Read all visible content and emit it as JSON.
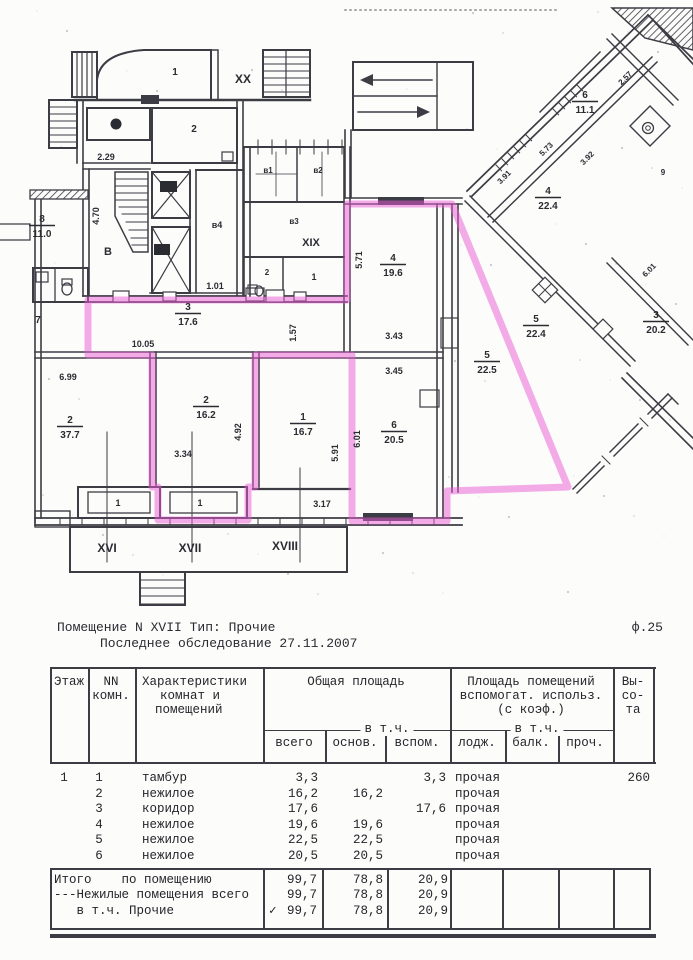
{
  "doc": {
    "title_line1": "Помещение N XVII Тип: Прочие",
    "form_ref": "ф.25",
    "title_line2": "Последнее обследование 27.11.2007"
  },
  "plan": {
    "highlight_color": "#ea5ad5",
    "fraction_labels": [
      {
        "n": "8",
        "a": "11.0",
        "x": 42,
        "y": 222
      },
      {
        "n": "3",
        "a": "17.6",
        "x": 188,
        "y": 310
      },
      {
        "n": "2",
        "a": "37.7",
        "x": 70,
        "y": 423
      },
      {
        "n": "2",
        "a": "16.2",
        "x": 206,
        "y": 403
      },
      {
        "n": "1",
        "a": "16.7",
        "x": 303,
        "y": 420
      },
      {
        "n": "6",
        "a": "20.5",
        "x": 394,
        "y": 428
      },
      {
        "n": "4",
        "a": "19.6",
        "x": 393,
        "y": 261
      },
      {
        "n": "5",
        "a": "22.5",
        "x": 487,
        "y": 358
      },
      {
        "n": "6",
        "a": "11.1",
        "x": 585,
        "y": 98
      },
      {
        "n": "4",
        "a": "22.4",
        "x": 548,
        "y": 194
      },
      {
        "n": "5",
        "a": "22.4",
        "x": 536,
        "y": 322
      },
      {
        "n": "3",
        "a": "20.2",
        "x": 656,
        "y": 318
      }
    ],
    "labels": [
      {
        "t": "1",
        "x": 175,
        "y": 75,
        "s": 10
      },
      {
        "t": "XX",
        "x": 243,
        "y": 83,
        "s": 12
      },
      {
        "t": "2",
        "x": 194,
        "y": 132,
        "s": 10
      },
      {
        "t": "2.29",
        "x": 106,
        "y": 160,
        "s": 9
      },
      {
        "t": "4.70",
        "x": 99,
        "y": 216,
        "s": 9,
        "r": -90
      },
      {
        "t": "В",
        "x": 108,
        "y": 255,
        "s": 11
      },
      {
        "t": "в4",
        "x": 217,
        "y": 228,
        "s": 9
      },
      {
        "t": "1.01",
        "x": 215,
        "y": 289,
        "s": 9
      },
      {
        "t": "в6",
        "x": 168,
        "y": 189,
        "s": 7,
        "inv": true
      },
      {
        "t": "в5",
        "x": 162,
        "y": 252,
        "s": 7,
        "inv": true
      },
      {
        "t": "8",
        "x": 116,
        "y": 127,
        "s": 7,
        "inv": true
      },
      {
        "t": "7",
        "x": 38,
        "y": 323,
        "s": 10
      },
      {
        "t": "в1",
        "x": 268,
        "y": 173,
        "s": 8
      },
      {
        "t": "в2",
        "x": 318,
        "y": 173,
        "s": 8
      },
      {
        "t": "в3",
        "x": 294,
        "y": 224,
        "s": 8
      },
      {
        "t": "XIX",
        "x": 311,
        "y": 246,
        "s": 11
      },
      {
        "t": "2",
        "x": 267,
        "y": 275,
        "s": 8
      },
      {
        "t": "1",
        "x": 314,
        "y": 280,
        "s": 9
      },
      {
        "t": "10.05",
        "x": 143,
        "y": 347,
        "s": 9
      },
      {
        "t": "1.57",
        "x": 296,
        "y": 333,
        "s": 9,
        "r": -90
      },
      {
        "t": "6.99",
        "x": 68,
        "y": 380,
        "s": 9
      },
      {
        "t": "3.34",
        "x": 183,
        "y": 457,
        "s": 9
      },
      {
        "t": "4.92",
        "x": 241,
        "y": 432,
        "s": 9,
        "r": -90
      },
      {
        "t": "5.91",
        "x": 338,
        "y": 453,
        "s": 9,
        "r": -90
      },
      {
        "t": "3.17",
        "x": 322,
        "y": 507,
        "s": 9
      },
      {
        "t": "3.45",
        "x": 394,
        "y": 374,
        "s": 9
      },
      {
        "t": "3.43",
        "x": 394,
        "y": 339,
        "s": 9
      },
      {
        "t": "6.01",
        "x": 360,
        "y": 439,
        "s": 9,
        "r": -90
      },
      {
        "t": "5.71",
        "x": 362,
        "y": 260,
        "s": 9,
        "r": -90
      },
      {
        "t": "1",
        "x": 118,
        "y": 506,
        "s": 9
      },
      {
        "t": "1",
        "x": 200,
        "y": 506,
        "s": 9
      },
      {
        "t": "XVI",
        "x": 107,
        "y": 552,
        "s": 12
      },
      {
        "t": "XVII",
        "x": 190,
        "y": 552,
        "s": 12
      },
      {
        "t": "XVIII",
        "x": 285,
        "y": 550,
        "s": 12
      },
      {
        "t": "3.91",
        "x": 506,
        "y": 179,
        "s": 8,
        "r": -45
      },
      {
        "t": "5.73",
        "x": 548,
        "y": 151,
        "s": 8,
        "r": -45
      },
      {
        "t": "3.92",
        "x": 589,
        "y": 160,
        "s": 8,
        "r": -45
      },
      {
        "t": "2.57",
        "x": 627,
        "y": 80,
        "s": 8,
        "r": -45
      },
      {
        "t": "6.01",
        "x": 651,
        "y": 272,
        "s": 8,
        "r": -45
      },
      {
        "t": "9",
        "x": 663,
        "y": 175,
        "s": 8
      }
    ]
  },
  "table": {
    "header": {
      "floor": "Этаж",
      "room_no": [
        "NN",
        "комн."
      ],
      "characteristics": [
        "Характеристики",
        "комнат и",
        "помещений"
      ],
      "total_area": "Общая площадь",
      "aux_area": [
        "Площадь помещений",
        "вспомогат. использ.",
        "(с коэф.)"
      ],
      "height": [
        "Вы-",
        "со-",
        "та"
      ],
      "incl": "в т.ч.",
      "sub": [
        "всего",
        "основ.",
        "вспом.",
        "лодж.",
        "балк.",
        "проч."
      ]
    },
    "rows": [
      {
        "floor": "1",
        "no": "1",
        "name": "тамбур",
        "total": "3,3",
        "main": "",
        "aux": "3,3",
        "lodge": "прочая",
        "height": "260"
      },
      {
        "floor": "",
        "no": "2",
        "name": "нежилое",
        "total": "16,2",
        "main": "16,2",
        "aux": "",
        "lodge": "прочая",
        "height": ""
      },
      {
        "floor": "",
        "no": "3",
        "name": "коридор",
        "total": "17,6",
        "main": "",
        "aux": "17,6",
        "lodge": "прочая",
        "height": ""
      },
      {
        "floor": "",
        "no": "4",
        "name": "нежилое",
        "total": "19,6",
        "main": "19,6",
        "aux": "",
        "lodge": "прочая",
        "height": ""
      },
      {
        "floor": "",
        "no": "5",
        "name": "нежилое",
        "total": "22,5",
        "main": "22,5",
        "aux": "",
        "lodge": "прочая",
        "height": ""
      },
      {
        "floor": "",
        "no": "6",
        "name": "нежилое",
        "total": "20,5",
        "main": "20,5",
        "aux": "",
        "lodge": "прочая",
        "height": ""
      }
    ],
    "totals": [
      {
        "label": "Итого    по помещению",
        "check": "",
        "total": "99,7",
        "main": "78,8",
        "aux": "20,9"
      },
      {
        "label": "---Нежилые помещения всего",
        "check": "",
        "total": "99,7",
        "main": "78,8",
        "aux": "20,9"
      },
      {
        "label": "   в т.ч. Прочие",
        "check": "✓",
        "total": "99,7",
        "main": "78,8",
        "aux": "20,9"
      }
    ]
  }
}
